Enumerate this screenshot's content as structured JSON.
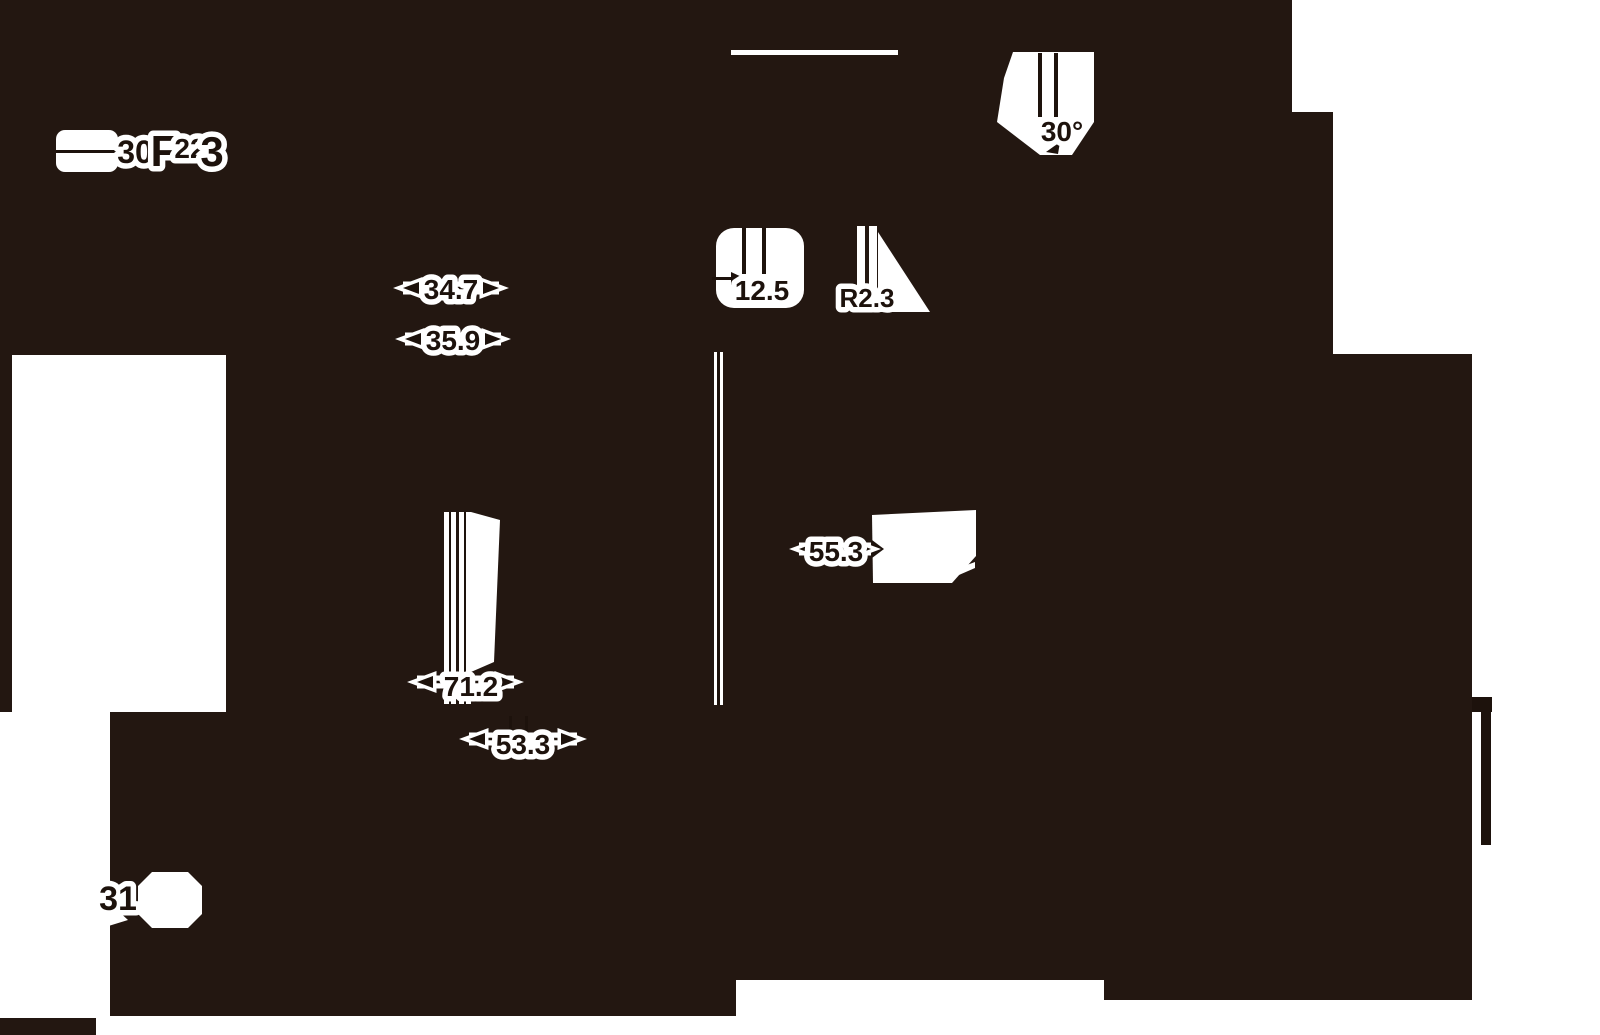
{
  "canvas": {
    "width": 1600,
    "height": 1035,
    "background": "#231711",
    "ink": "#1d120c",
    "paper": "#ffffff"
  },
  "drawing": {
    "description_labels": [
      "30",
      "F",
      "22",
      "3",
      "34.7",
      "35.9",
      "12.5",
      "R2.3",
      "30°",
      "55.3",
      "71.2",
      "53.3",
      "31"
    ]
  },
  "white_shapes": [
    {
      "name": "right-white-region",
      "type": "polygon",
      "points": [
        [
          1292,
          0
        ],
        [
          1600,
          0
        ],
        [
          1600,
          1035
        ],
        [
          1472,
          1035
        ],
        [
          1472,
          354
        ],
        [
          1333,
          354
        ],
        [
          1333,
          112
        ],
        [
          1292,
          112
        ]
      ]
    },
    {
      "name": "left-white-rect",
      "type": "polygon",
      "points": [
        [
          12,
          355
        ],
        [
          226,
          355
        ],
        [
          226,
          712
        ],
        [
          12,
          712
        ]
      ]
    },
    {
      "name": "left-white-column",
      "type": "polygon",
      "points": [
        [
          0,
          712
        ],
        [
          110,
          712
        ],
        [
          110,
          1018
        ],
        [
          0,
          1018
        ]
      ]
    },
    {
      "name": "bottom-white-strip",
      "type": "polygon",
      "points": [
        [
          96,
          1016
        ],
        [
          736,
          1016
        ],
        [
          736,
          1035
        ],
        [
          96,
          1035
        ]
      ]
    },
    {
      "name": "bottom-white-mid",
      "type": "polygon",
      "points": [
        [
          736,
          980
        ],
        [
          1104,
          980
        ],
        [
          1104,
          1035
        ],
        [
          736,
          1035
        ]
      ]
    },
    {
      "name": "bottom-white-right",
      "type": "polygon",
      "points": [
        [
          1104,
          1000
        ],
        [
          1472,
          1000
        ],
        [
          1472,
          1035
        ],
        [
          1104,
          1035
        ]
      ]
    },
    {
      "name": "ext-line-125-halo",
      "type": "rect",
      "x": 714,
      "y": 352,
      "w": 9,
      "h": 353
    },
    {
      "name": "top-edge-line",
      "type": "rect",
      "x": 731,
      "y": 50,
      "w": 167,
      "h": 5
    },
    {
      "name": "pill-30",
      "type": "rect",
      "x": 56,
      "y": 130,
      "w": 62,
      "h": 42,
      "rx": 9
    },
    {
      "name": "blob-125",
      "type": "rect",
      "x": 716,
      "y": 228,
      "w": 88,
      "h": 80,
      "rx": 18
    },
    {
      "name": "r23-ext-line-a",
      "type": "rect",
      "x": 857,
      "y": 226,
      "w": 8,
      "h": 74
    },
    {
      "name": "r23-ext-line-b",
      "type": "rect",
      "x": 869,
      "y": 226,
      "w": 8,
      "h": 74
    },
    {
      "name": "r23-fill-triangle",
      "type": "polygon",
      "points": [
        [
          878,
          232
        ],
        [
          930,
          312
        ],
        [
          878,
          312
        ]
      ]
    },
    {
      "name": "deg30-blob",
      "type": "polygon",
      "points": [
        [
          1013,
          52
        ],
        [
          1094,
          52
        ],
        [
          1094,
          122
        ],
        [
          1072,
          155
        ],
        [
          1040,
          155
        ],
        [
          997,
          122
        ],
        [
          1004,
          78
        ]
      ]
    },
    {
      "name": "rect-553",
      "type": "polygon",
      "points": [
        [
          872,
          515
        ],
        [
          976,
          510
        ],
        [
          976,
          556
        ],
        [
          952,
          583
        ],
        [
          873,
          583
        ]
      ]
    },
    {
      "name": "sliver-553",
      "type": "polygon",
      "points": [
        [
          948,
          572
        ],
        [
          975,
          562
        ],
        [
          975,
          568
        ],
        [
          952,
          578
        ]
      ]
    },
    {
      "name": "ext-line-712-a",
      "type": "rect",
      "x": 444,
      "y": 512,
      "w": 12,
      "h": 192
    },
    {
      "name": "ext-line-712-b",
      "type": "rect",
      "x": 459,
      "y": 512,
      "w": 12,
      "h": 192
    },
    {
      "name": "wedge-712",
      "type": "polygon",
      "points": [
        [
          471,
          512
        ],
        [
          500,
          520
        ],
        [
          494,
          662
        ],
        [
          471,
          672
        ]
      ]
    },
    {
      "name": "blob-31",
      "type": "polygon",
      "points": [
        [
          138,
          886
        ],
        [
          152,
          872
        ],
        [
          188,
          872
        ],
        [
          202,
          886
        ],
        [
          202,
          914
        ],
        [
          188,
          928
        ],
        [
          152,
          928
        ],
        [
          138,
          914
        ]
      ]
    },
    {
      "name": "spike-31",
      "type": "polygon",
      "points": [
        [
          104,
          898
        ],
        [
          128,
          920
        ],
        [
          102,
          928
        ]
      ]
    }
  ],
  "ink_shapes": [
    {
      "name": "right-black-bar",
      "type": "rect",
      "x": 1481,
      "y": 697,
      "w": 10,
      "h": 148
    },
    {
      "name": "right-black-notch",
      "type": "rect",
      "x": 1472,
      "y": 697,
      "w": 20,
      "h": 15
    },
    {
      "name": "ext-line-125-core",
      "type": "rect",
      "x": 717,
      "y": 352,
      "w": 3,
      "h": 353
    },
    {
      "name": "pill-dim-line",
      "type": "rect",
      "x": 56,
      "y": 150,
      "w": 80,
      "h": 3
    },
    {
      "name": "pill-arrowhead",
      "type": "polygon",
      "points": [
        [
          140,
          151
        ],
        [
          126,
          145
        ],
        [
          126,
          158
        ]
      ]
    },
    {
      "name": "l125-ext-a",
      "type": "rect",
      "x": 742,
      "y": 228,
      "w": 4,
      "h": 46
    },
    {
      "name": "l125-ext-b",
      "type": "rect",
      "x": 762,
      "y": 228,
      "w": 4,
      "h": 46
    },
    {
      "name": "l125-dim-line",
      "type": "rect",
      "x": 712,
      "y": 277,
      "w": 28,
      "h": 3
    },
    {
      "name": "l125-arrowhead",
      "type": "polygon",
      "points": [
        [
          744,
          278
        ],
        [
          731,
          272
        ],
        [
          731,
          285
        ]
      ]
    },
    {
      "name": "deg30-ext-a",
      "type": "rect",
      "x": 1038,
      "y": 53,
      "w": 4,
      "h": 64
    },
    {
      "name": "deg30-ext-b",
      "type": "rect",
      "x": 1054,
      "y": 53,
      "w": 4,
      "h": 64
    },
    {
      "name": "deg30-arrowhead",
      "type": "polygon",
      "points": [
        [
          1046,
          152
        ],
        [
          1060,
          142
        ],
        [
          1058,
          154
        ]
      ]
    },
    {
      "name": "stub-533-a",
      "type": "rect",
      "x": 509,
      "y": 716,
      "w": 3,
      "h": 20
    },
    {
      "name": "stub-533-b",
      "type": "rect",
      "x": 525,
      "y": 716,
      "w": 3,
      "h": 20
    },
    {
      "name": "notch-553",
      "type": "polygon",
      "points": [
        [
          872,
          540
        ],
        [
          884,
          549
        ],
        [
          872,
          558
        ]
      ]
    },
    {
      "name": "ext-line-712-core-a",
      "type": "rect",
      "x": 449,
      "y": 512,
      "w": 2,
      "h": 192
    },
    {
      "name": "ext-line-712-core-b",
      "type": "rect",
      "x": 464,
      "y": 512,
      "w": 2,
      "h": 192
    }
  ],
  "dimensions": [
    {
      "name": "dim-347",
      "label": "34.7",
      "y": 288,
      "x1": 403,
      "x2": 499,
      "tx": 451,
      "ty": 299,
      "size": 28
    },
    {
      "name": "dim-359",
      "label": "35.9",
      "y": 339,
      "x1": 405,
      "x2": 501,
      "tx": 453,
      "ty": 350,
      "size": 28
    },
    {
      "name": "dim-533",
      "label": "53.3",
      "y": 739,
      "x1": 469,
      "x2": 577,
      "tx": 523,
      "ty": 754,
      "size": 28
    },
    {
      "name": "dim-553",
      "label": "55.3",
      "y": 549,
      "x1": 799,
      "x2": 871,
      "tx": 836,
      "ty": 561,
      "size": 28
    },
    {
      "name": "dim-712",
      "label": "71.2",
      "y": 682,
      "x1": 417,
      "x2": 514,
      "tx": 471,
      "ty": 696,
      "size": 28
    }
  ],
  "labels": [
    {
      "name": "label-125",
      "text": "12.5",
      "x": 762,
      "y": 300,
      "size": 28
    },
    {
      "name": "label-r23",
      "text": "R2.3",
      "x": 867,
      "y": 307,
      "size": 26
    },
    {
      "name": "label-30deg",
      "text": "30°",
      "x": 1062,
      "y": 141,
      "size": 28
    },
    {
      "name": "label-31",
      "text": "31",
      "x": 118,
      "y": 910,
      "size": 34
    },
    {
      "name": "label-30",
      "text": "30",
      "x": 135,
      "y": 163,
      "size": 32
    },
    {
      "name": "label-f",
      "text": "F",
      "x": 164,
      "y": 166,
      "size": 44
    },
    {
      "name": "label-22",
      "text": "22",
      "x": 190,
      "y": 158,
      "size": 28
    },
    {
      "name": "label-3",
      "text": "3",
      "x": 212,
      "y": 166,
      "size": 42
    }
  ]
}
